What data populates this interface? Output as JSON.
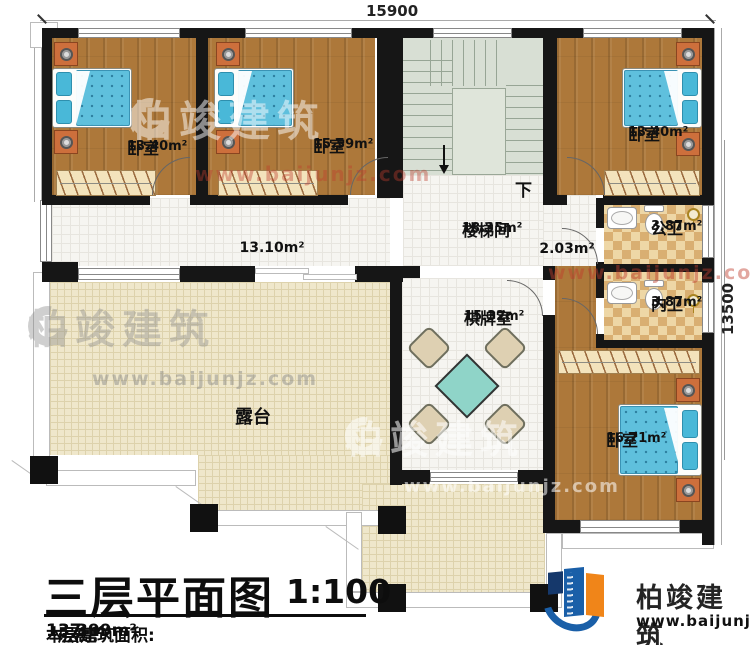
{
  "dimensions": {
    "top": "15900",
    "right": "13500"
  },
  "rooms": {
    "bedroom1": {
      "name": "卧室",
      "area": "13.40m²"
    },
    "bedroom2": {
      "name": "卧室",
      "area": "15.59m²"
    },
    "bedroom3": {
      "name": "卧室",
      "area": "13.40m²"
    },
    "bedroom4": {
      "name": "卧室",
      "area": "16.71m²"
    },
    "stairwell": {
      "name": "楼梯间",
      "area": "18.35m²"
    },
    "hall": {
      "area": "2.03m²"
    },
    "corridor": {
      "area": "13.10m²"
    },
    "public_bath": {
      "name": "公卫",
      "area": "3.87m²"
    },
    "private_bath": {
      "name": "内卫",
      "area": "3.87m²"
    },
    "chess_room": {
      "name": "棋牌室",
      "area": "15.32m²"
    },
    "terrace": {
      "name": "露台"
    }
  },
  "labels": {
    "down": "下"
  },
  "title_block": {
    "title": "三层平面图",
    "scale": "1:100",
    "area_label": "本层建筑面积:",
    "area_value": "137.99m²",
    "height_label": "层高:",
    "height_value": "3.3m"
  },
  "logo": {
    "name": "柏竣建筑",
    "url": "www.baijunjz.com"
  },
  "watermark": {
    "name": "柏竣建筑",
    "url": "www.baijunjz.com"
  },
  "colors": {
    "wall": "#161616",
    "wood_floor": "#ad783a",
    "tile_floor": "#f6f5f1",
    "terrace_floor": "#efe7cb",
    "stair_floor": "#d8dfd4",
    "bath_tile_light": "#eed7a6",
    "bath_tile_dark": "#d9af72",
    "bed_blanket": "#5fc0dd",
    "pillow": "#49b8d8",
    "nightstand": "#cd6f3c",
    "table": "#8fd4c8",
    "chair": "#ded0b2",
    "logo_blue": "#1a5fa8",
    "logo_orange": "#f08519"
  }
}
